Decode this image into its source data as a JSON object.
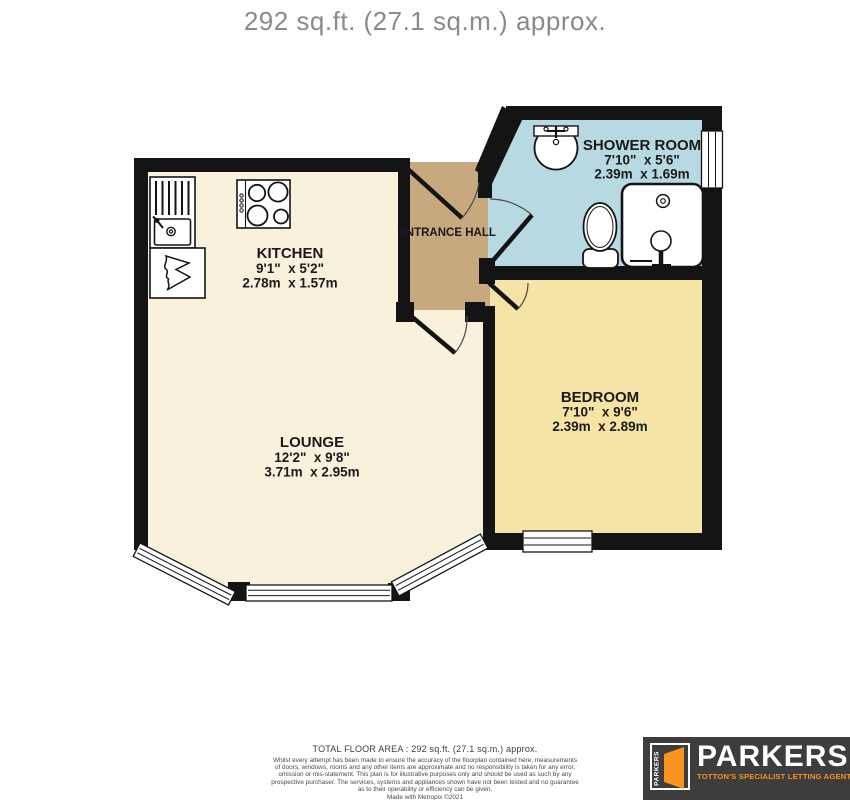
{
  "title": "292 sq.ft. (27.1 sq.m.) approx.",
  "floorplan": {
    "colors": {
      "wall": "#141414",
      "lounge_kitchen_floor": "#F8F2DC",
      "entrance_hall_floor": "#C8A87E",
      "shower_room_floor": "#B7D9E2",
      "bedroom_floor": "#F5E4A6"
    },
    "rooms": {
      "kitchen": {
        "name": "KITCHEN",
        "imperial": "9'1\"  x 5'2\"",
        "metric": "2.78m  x 1.57m"
      },
      "lounge": {
        "name": "LOUNGE",
        "imperial": "12'2\"  x 9'8\"",
        "metric": "3.71m  x 2.95m"
      },
      "entrance_hall": {
        "name": "ENTRANCE HALL"
      },
      "shower_room": {
        "name": "SHOWER ROOM",
        "imperial": "7'10\"  x 5'6\"",
        "metric": "2.39m  x 1.69m"
      },
      "bedroom": {
        "name": "BEDROOM",
        "imperial": "7'10\"  x 9'6\"",
        "metric": "2.39m  x 2.89m"
      }
    }
  },
  "footer": {
    "total_area": "TOTAL FLOOR AREA : 292 sq.ft. (27.1 sq.m.) approx.",
    "disclaimer_lines": [
      "Whilst every attempt has been made to ensure the accuracy of the floorplan contained here, measurements",
      "of doors, windows, rooms and any other items are approximate and no responsibility is taken for any error,",
      "omission or mis-statement. This plan is for illustrative purposes only and should be used as such by any",
      "prospective purchaser. The services, systems and appliances shown have not been tested and no guarantee",
      "as to their operability or efficiency can be given."
    ],
    "credit": "Made with Metropix ©2021"
  },
  "logo": {
    "brand": "PARKERS",
    "badge_vertical_text": "PARKERS",
    "tagline": "TOTTON'S SPECIALIST LETTING AGENT",
    "colors": {
      "background": "#3D3D3D",
      "accent": "#F7941D"
    }
  }
}
